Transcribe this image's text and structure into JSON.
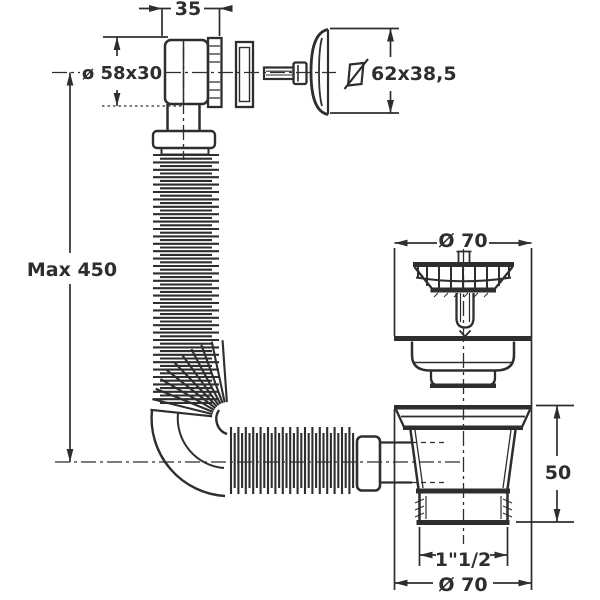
{
  "drawing": {
    "type": "technical-dimension-drawing",
    "subject": "sink-drain-with-flexible-overflow-hose",
    "colors": {
      "line": "#2e2e2e",
      "background": "#ffffff"
    },
    "dimensions": {
      "elbow_depth": "35",
      "overflow_elbow_size": "ø 58x30",
      "overflow_cover_size": "62x38,5",
      "hose_max_length": "Max 450",
      "strainer_diameter": "Ø 70",
      "cup_height": "50",
      "outlet_thread": "1\"1/2",
      "cup_diameter": "Ø 70"
    },
    "icons": {
      "overflow_cover_symbol": "slashed-square"
    }
  }
}
